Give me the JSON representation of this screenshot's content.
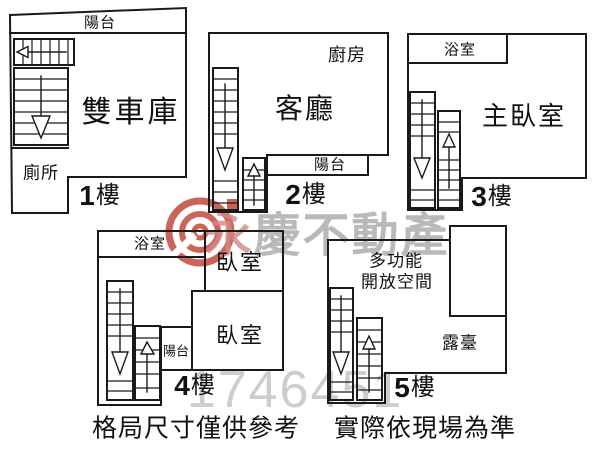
{
  "floors": {
    "f1": {
      "num": "1",
      "suffix": "樓",
      "balcony": "陽台",
      "garage": "雙車庫",
      "toilet": "廁所"
    },
    "f2": {
      "num": "2",
      "suffix": "樓",
      "kitchen": "廚房",
      "living_room": "客廳",
      "balcony": "陽台"
    },
    "f3": {
      "num": "3",
      "suffix": "樓",
      "bathroom": "浴室",
      "master_bedroom": "主臥室"
    },
    "f4": {
      "num": "4",
      "suffix": "樓",
      "bathroom": "浴室",
      "bedroom_upper": "臥室",
      "bedroom_lower": "臥室",
      "balcony": "陽台"
    },
    "f5": {
      "num": "5",
      "suffix": "樓",
      "multi_line1": "多功能",
      "multi_line2": "開放空間",
      "terrace": "露臺"
    }
  },
  "footer": {
    "left_note": "格局尺寸僅供參考",
    "right_note": "實際依現場為準"
  },
  "watermark": {
    "brand_first_char": "永",
    "brand_rest": "慶不動產",
    "listing_number": "1746451"
  },
  "colors": {
    "wall": "#1a1a1a",
    "logo_red": "#c0392b",
    "brand_gray": "#a8a8a8",
    "brand_pink": "#d08a84",
    "number_gray": "#c8c8c8",
    "background": "#ffffff"
  }
}
